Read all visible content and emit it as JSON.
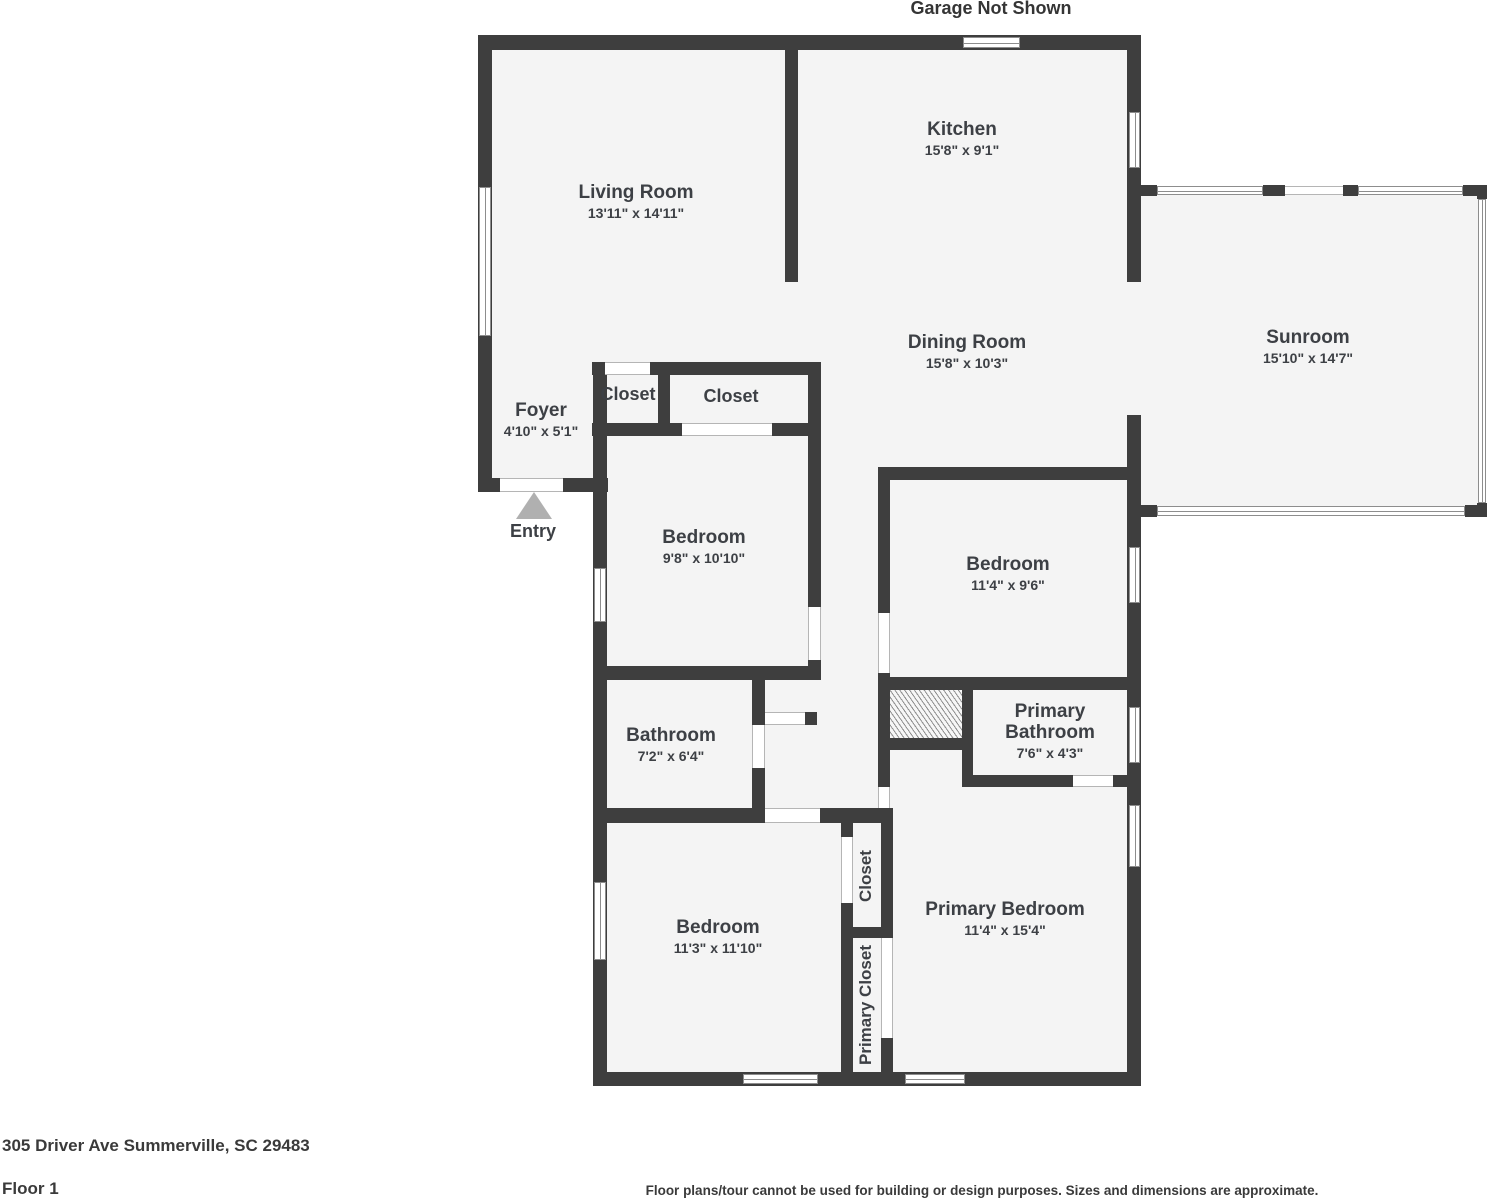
{
  "header": {
    "garage_note": "Garage Not Shown"
  },
  "rooms": {
    "living_room": {
      "name": "Living Room",
      "dims": "13'11\" x 14'11\""
    },
    "kitchen": {
      "name": "Kitchen",
      "dims": "15'8\" x 9'1\""
    },
    "dining_room": {
      "name": "Dining Room",
      "dims": "15'8\" x 10'3\""
    },
    "sunroom": {
      "name": "Sunroom",
      "dims": "15'10\" x 14'7\""
    },
    "foyer": {
      "name": "Foyer",
      "dims": "4'10\" x 5'1\""
    },
    "entry": {
      "name": "Entry"
    },
    "closet_a": {
      "name": "Closet"
    },
    "closet_b": {
      "name": "Closet"
    },
    "bedroom_front": {
      "name": "Bedroom",
      "dims": "9'8\" x 10'10\""
    },
    "bedroom_middle": {
      "name": "Bedroom",
      "dims": "11'4\" x 9'6\""
    },
    "bathroom": {
      "name": "Bathroom",
      "dims": "7'2\" x 6'4\""
    },
    "primary_bathroom": {
      "name": "Primary Bathroom",
      "dims": "7'6\" x 4'3\""
    },
    "closet_hall": {
      "name": "Closet"
    },
    "bedroom_back": {
      "name": "Bedroom",
      "dims": "11'3\" x 11'10\""
    },
    "primary_closet": {
      "name": "Primary Closet"
    },
    "primary_bedroom": {
      "name": "Primary Bedroom",
      "dims": "11'4\" x 15'4\""
    }
  },
  "footer": {
    "address": "305 Driver Ave Summerville, SC 29483",
    "floor_label": "Floor 1",
    "disclaimer": "Floor plans/tour cannot be used for building or design purposes. Sizes and dimensions are approximate."
  },
  "colors": {
    "wall": "#3e3e3e",
    "floor": "#f4f4f4",
    "text": "#3d4045",
    "entry_arrow": "#b0b0b0"
  }
}
